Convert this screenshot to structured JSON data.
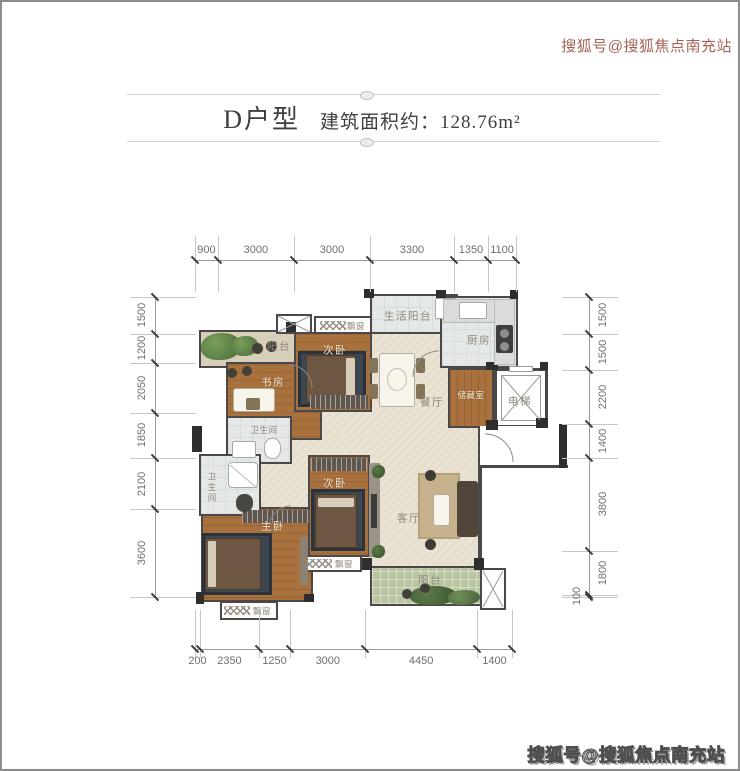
{
  "header": {
    "unit_label": "D户型",
    "area_label": "建筑面积约：128.76m²"
  },
  "watermark_top": {
    "text": "搜狐号@搜狐焦点南充站"
  },
  "watermark_bottom": {
    "text": "搜狐号@搜狐焦点南充站"
  },
  "floorplan": {
    "rooms": {
      "balcony_top": "阳台",
      "study": "书房",
      "bedroom_top": "次卧",
      "service_balcony": "生活阳台",
      "kitchen": "厨房",
      "storage": "储藏室",
      "elevator": "电梯",
      "dining": "餐厅",
      "bath1": "卫生间",
      "bath2": "卫生间",
      "bedroom_mid": "次卧",
      "master": "主卧",
      "living": "客厅",
      "balcony_bottom": "阳台",
      "bay_top": "飘窗",
      "bay_mid": "飘窗",
      "bay_bottom": "飘窗"
    }
  },
  "dimensions": {
    "top": {
      "values": [
        900,
        3000,
        3000,
        3300,
        1350,
        1100
      ]
    },
    "bottom": {
      "values": [
        200,
        2350,
        1250,
        3000,
        4450,
        1400
      ]
    },
    "left": {
      "values": [
        1500,
        1200,
        2050,
        1850,
        2100,
        3600
      ]
    },
    "right": {
      "values": [
        1500,
        1500,
        2200,
        1400,
        3800,
        1800,
        100
      ]
    }
  },
  "colors": {
    "wall": "#4b4947",
    "wood_floor": "#a9713e",
    "tile_beige": "#eae3d3",
    "tile_light": "#e4e8e6",
    "balcony_green": "#b9c6a1",
    "dim_text": "#6f6f6f",
    "title_text": "#3f3f3f",
    "watermark_top_color": "#9c5244"
  }
}
